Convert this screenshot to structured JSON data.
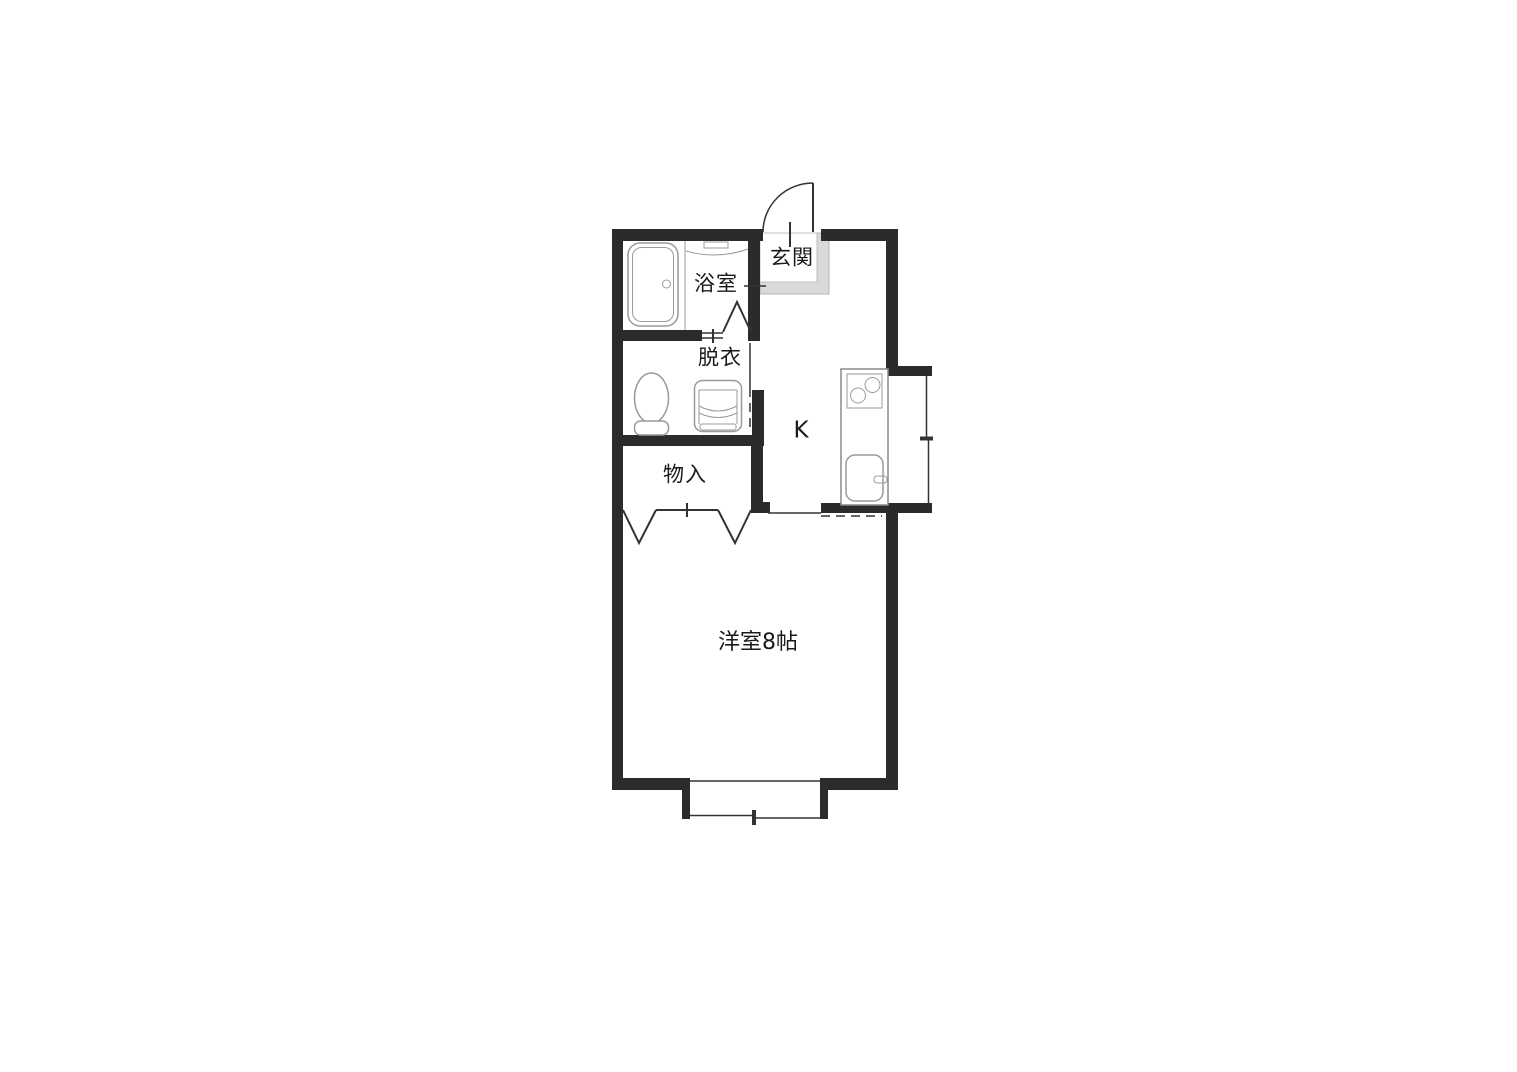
{
  "plan": {
    "type": "floorplan",
    "rooms": {
      "bath": {
        "label": "浴室"
      },
      "dressing": {
        "label": "脱衣"
      },
      "entrance": {
        "label": "玄関"
      },
      "kitchen": {
        "label": "K"
      },
      "closet": {
        "label": "物入"
      },
      "western_room": {
        "label": "洋室8帖"
      }
    },
    "fixtures": [
      "bathtub-icon",
      "toilet-icon",
      "washing-machine-icon",
      "kitchen-unit-icon",
      "stove-icon",
      "sink-icon",
      "entrance-door-swing-icon",
      "bath-folding-door-icon",
      "closet-folding-door-icon",
      "window-bottom-icon",
      "window-right-icon"
    ]
  },
  "colors": {
    "wall": "#2b2b2b",
    "line": "#333333",
    "fixture": "#9a9a9a",
    "kitchen": "#8a8a8a",
    "step_fill": "#d9d9d9",
    "step_edge": "#b5b5b5",
    "background": "#ffffff",
    "text": "#1a1a1a"
  }
}
